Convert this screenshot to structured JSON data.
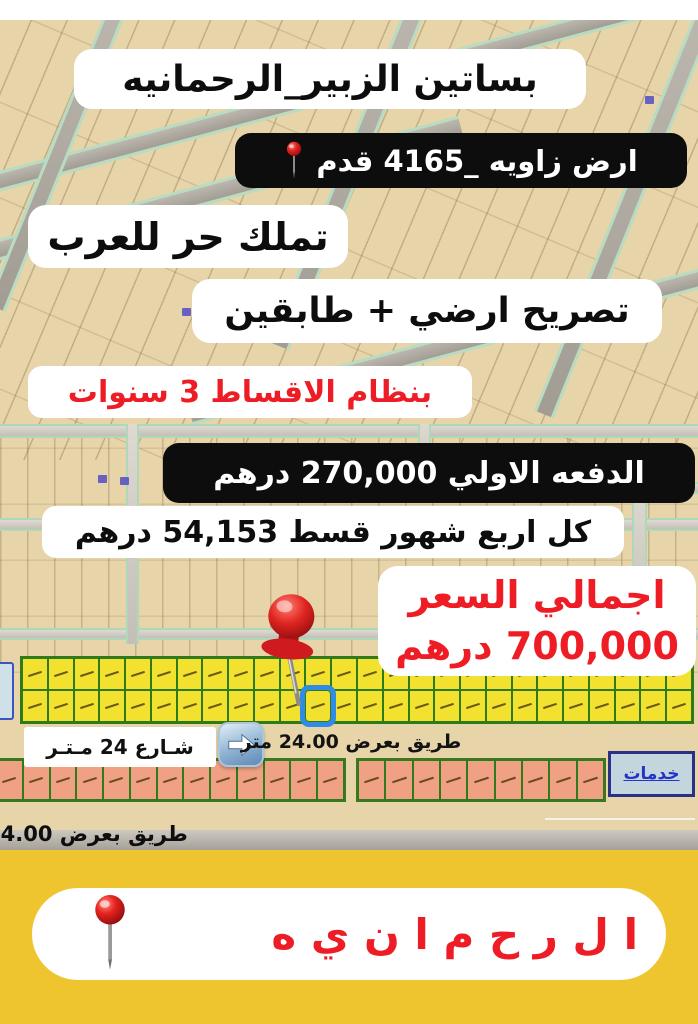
{
  "overlays": {
    "title": "بساتين الزبير_الرحمانيه",
    "plot": "ارض زاويه _4165 قدم",
    "ownership": "تملك حر للعرب",
    "permit": "تصريح ارضي + طابقين",
    "installments": "بنظام الاقساط 3 سنوات",
    "down_payment": "الدفعه الاولي 270,000 درهم",
    "quarterly": "كل اربع شهور قسط 54,153 درهم",
    "total_price_label": "اجمالي السعر",
    "total_price_value": "700,000 درهم"
  },
  "map": {
    "street_sign": "شـارع 24 مـتـر",
    "road_24": "طريق بعرض 24.00 متر",
    "road_54": "طريق بعرض 54.00",
    "services": "خدمات",
    "parcels": {
      "yellow": {
        "rows": 2,
        "cols": 26,
        "highlight": {
          "row": 1,
          "col": 11
        }
      },
      "salmon_a": {
        "rows": 1,
        "cols": 13
      },
      "salmon_b": {
        "rows": 1,
        "cols": 9
      }
    }
  },
  "banner": {
    "name": "ا ل ر ح م ا ن ي ه"
  },
  "icons": {
    "pin": "red-round-map-pin",
    "pushpin": "red-thumbtack",
    "arrow": "right-arrow-button"
  },
  "colors": {
    "accent_red": "#ee1c25",
    "black_box": "#0d0d0d",
    "banner_yellow": "#eec52e",
    "parcel_yellow": "#f2e12e",
    "parcel_salmon": "#f0a184",
    "parcel_border_green": "#2f7a1a",
    "highlight_blue": "#2e8be8",
    "services_blue": "#2433c9",
    "map_tan": "#e7d4a9"
  }
}
